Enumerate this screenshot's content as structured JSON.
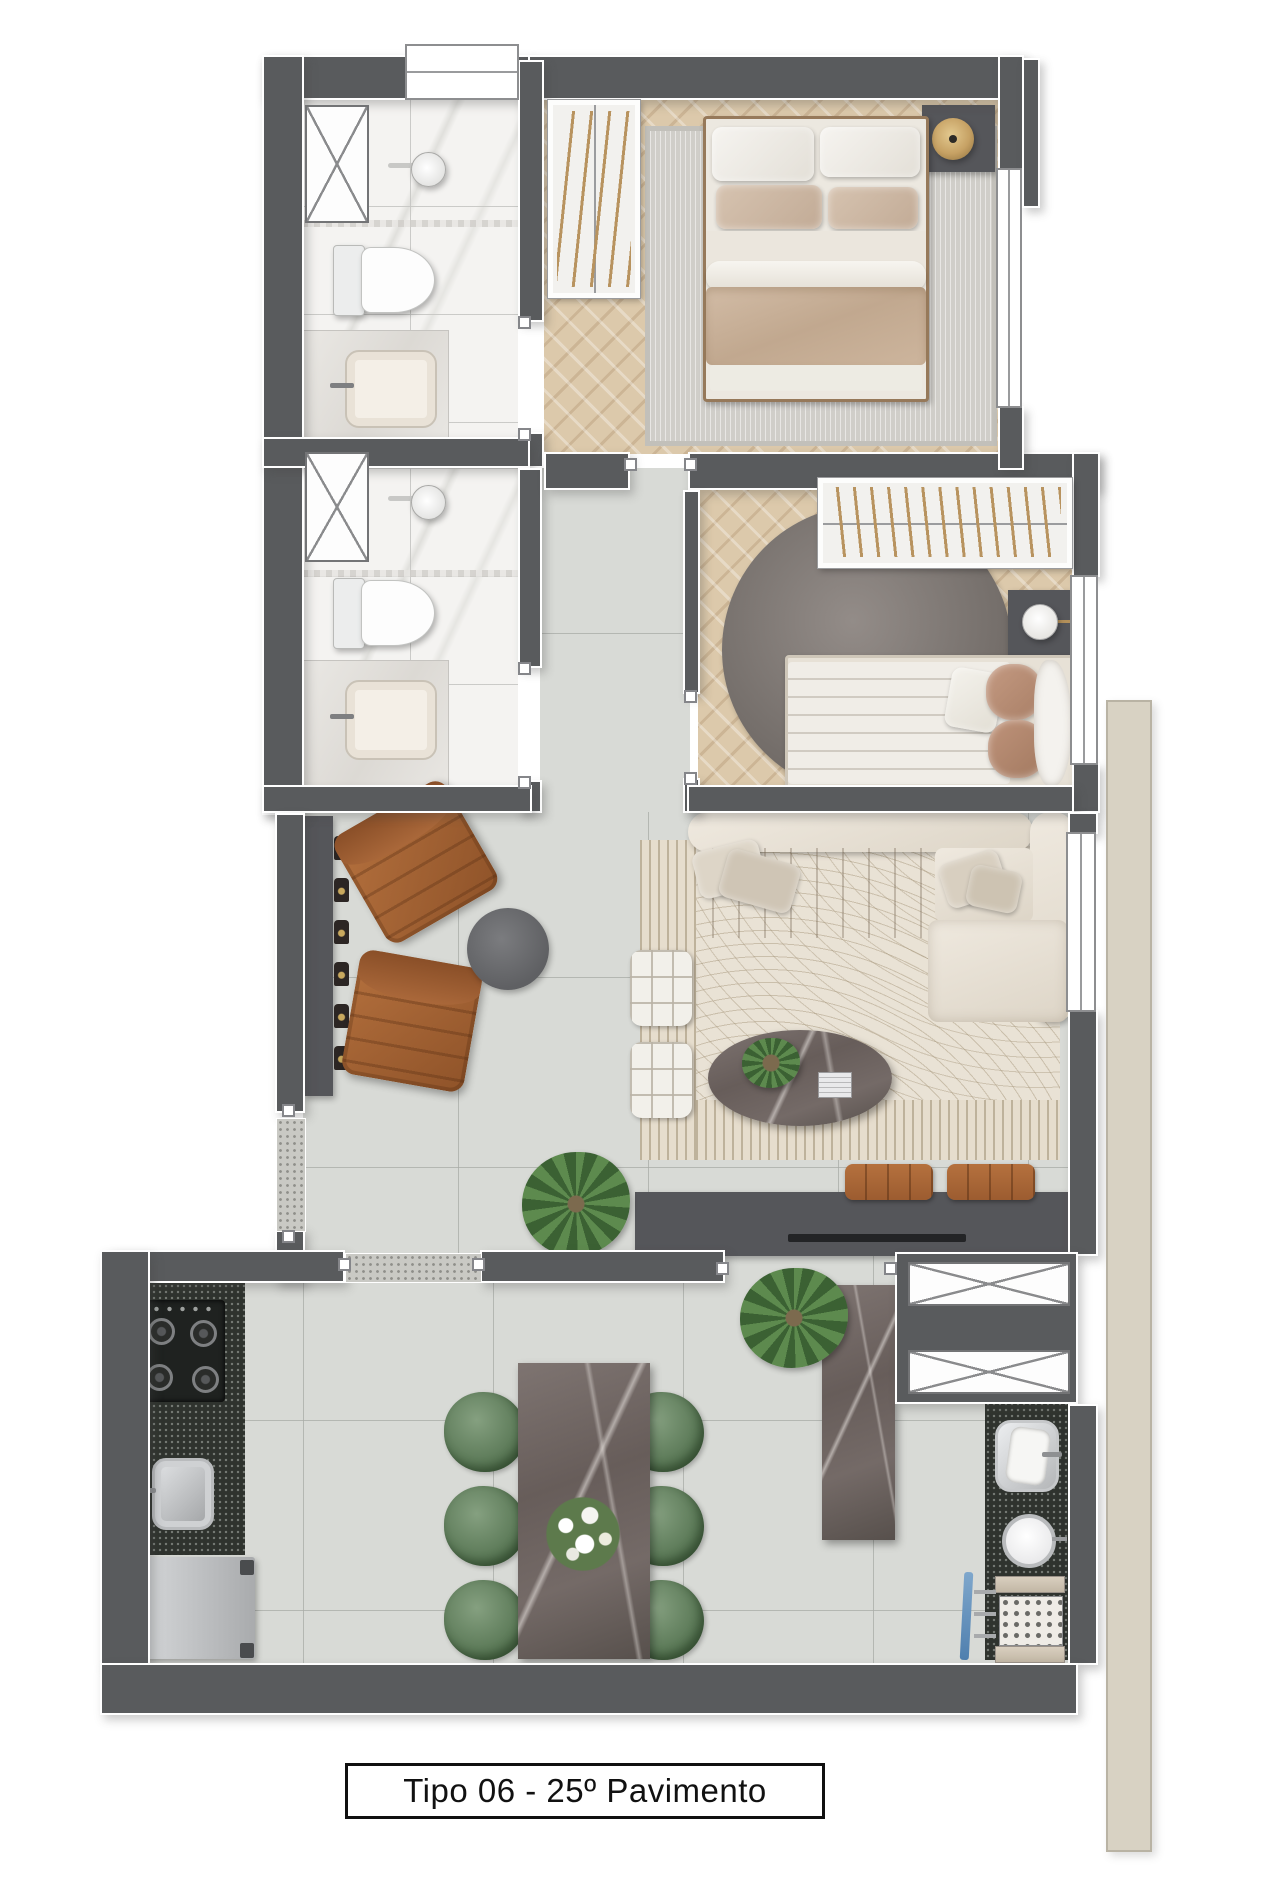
{
  "caption": {
    "text": "Tipo 06 - 25º Pavimento"
  },
  "floor_plan": {
    "type": "apartment-floor-plan-top-view",
    "unit_type": "Tipo 06",
    "floor": "25º Pavimento",
    "rooms": [
      {
        "name": "ensuite-bathroom",
        "fixtures": [
          "window",
          "ventilation-shaft",
          "shower",
          "toilet",
          "vanity-sink"
        ]
      },
      {
        "name": "second-bathroom",
        "fixtures": [
          "ventilation-shaft",
          "shower",
          "toilet",
          "vanity-sink"
        ]
      },
      {
        "name": "master-bedroom",
        "furniture": [
          "hanger-closet",
          "double-bed",
          "area-rug",
          "nightstand",
          "gold-pendant-lamp",
          "window"
        ]
      },
      {
        "name": "second-bedroom",
        "furniture": [
          "hanger-closet",
          "round-rug",
          "single-bed",
          "nightstand",
          "table-lamp",
          "window"
        ]
      },
      {
        "name": "hallway",
        "furniture": []
      },
      {
        "name": "living-room",
        "furniture": [
          "console-with-bottles",
          "leather-armchair",
          "leather-armchair",
          "round-ottoman",
          "sectional-sofa",
          "patterned-rug",
          "quilted-pouf",
          "quilted-pouf",
          "oval-marble-coffee-table",
          "tv-sideboard",
          "seat-cushion",
          "seat-cushion",
          "potted-plant",
          "window"
        ]
      },
      {
        "name": "kitchen-dining",
        "furniture": [
          "cooktop-4-burners",
          "kitchen-sink",
          "refrigerator",
          "marble-dining-table",
          "green-chair",
          "green-chair",
          "green-chair",
          "green-chair",
          "green-chair",
          "green-chair",
          "flower-centerpiece",
          "marble-island",
          "potted-plant"
        ]
      },
      {
        "name": "laundry-area",
        "fixtures": [
          "laundry-tub",
          "round-basin",
          "drying-rack",
          "ventilation-shaft",
          "ventilation-shaft"
        ]
      }
    ],
    "colors": {
      "wall": "#595b5d",
      "wood_floor": "#dcc9ab",
      "tile_floor": "#d8dad6",
      "marble_floor": "#f4f3f1",
      "leather": "#a96a3b",
      "sofa_cream": "#e8e2d6",
      "duvet_beige": "#c9b29c",
      "green_chair": "#5c7a58",
      "dark_counter": "#2f332e",
      "gold": "#c6a164",
      "neighbor_slab": "#d8d2c3"
    }
  }
}
